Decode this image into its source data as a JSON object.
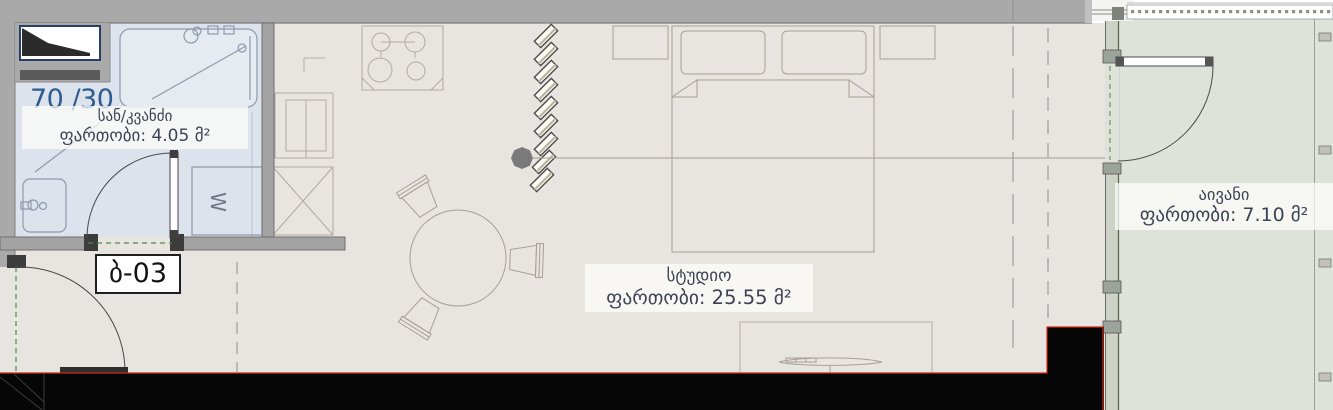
{
  "unit": {
    "number": "ბ-03",
    "ratio": "70 /30"
  },
  "rooms": {
    "bathroom": {
      "name": "სან/კვანძი",
      "area": "ფართობი: 4.05 მ²"
    },
    "studio": {
      "name": "სტუდიო",
      "area": "ფართობი: 25.55 მ²"
    },
    "balcony": {
      "name": "აივანი",
      "area": "ფართობი: 7.10 მ²"
    }
  },
  "symbols": {
    "washing_machine": "W"
  },
  "colors": {
    "studio_floor": "#e8e4df",
    "bathroom_floor": "#dce3ec",
    "balcony_floor": "#dee3d9",
    "wall": "#a9a9a9",
    "cut_line": "#cf2a1b",
    "label_text": "#3d4254",
    "ratio_text": "#2d5c90"
  }
}
